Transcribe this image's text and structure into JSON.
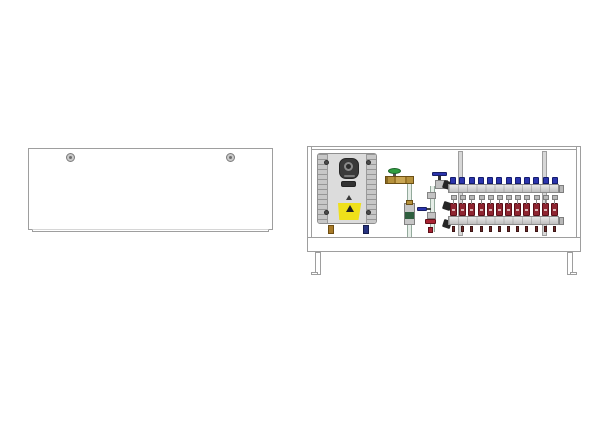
{
  "illustration": {
    "name": "underfloor-heating-manifold-cabinet-set",
    "left_figure": "closed front cover panel with two fixing screws",
    "right_figure": "open cabinet with heat interface unit, mixing valve piping and 12-circuit manifold",
    "background": "#ffffff"
  },
  "colors": {
    "line": "#9e9e9e",
    "fill": "#ffffff",
    "rail": "#d7d7d7",
    "screw_ring": "#7c7c7c",
    "screw_fill": "#c9c9c9",
    "heater_body": "#dcdcdc",
    "heater_side": "#c7c7c7",
    "display_dark": "#3a3a3a",
    "warning_yellow": "#efe01a",
    "brass": "#b5913c",
    "green_handle": "#2f9e41",
    "blue_handle": "#2b34ad",
    "red_handle": "#a82332",
    "flow_meter_red": "#8e2430",
    "pipe_fill": "#e6eee8",
    "pipe_edge": "#93aa9c",
    "chrome_light": "#e8e8e8",
    "chrome_dark": "#bfbfbf",
    "union_black": "#262626",
    "fitting_brass": "#a87a28",
    "fitting_blue": "#27337f"
  },
  "cover_panel": {
    "screw_count": 2
  },
  "cabinet": {
    "mounting_rail_count": 2,
    "leg_count": 2
  },
  "heater_unit": {
    "corner_screw_count": 4,
    "has_warning_label": true
  },
  "manifold": {
    "circuit_count": 12,
    "top_caps": 12,
    "flow_meters": 12,
    "outlets": 12
  }
}
